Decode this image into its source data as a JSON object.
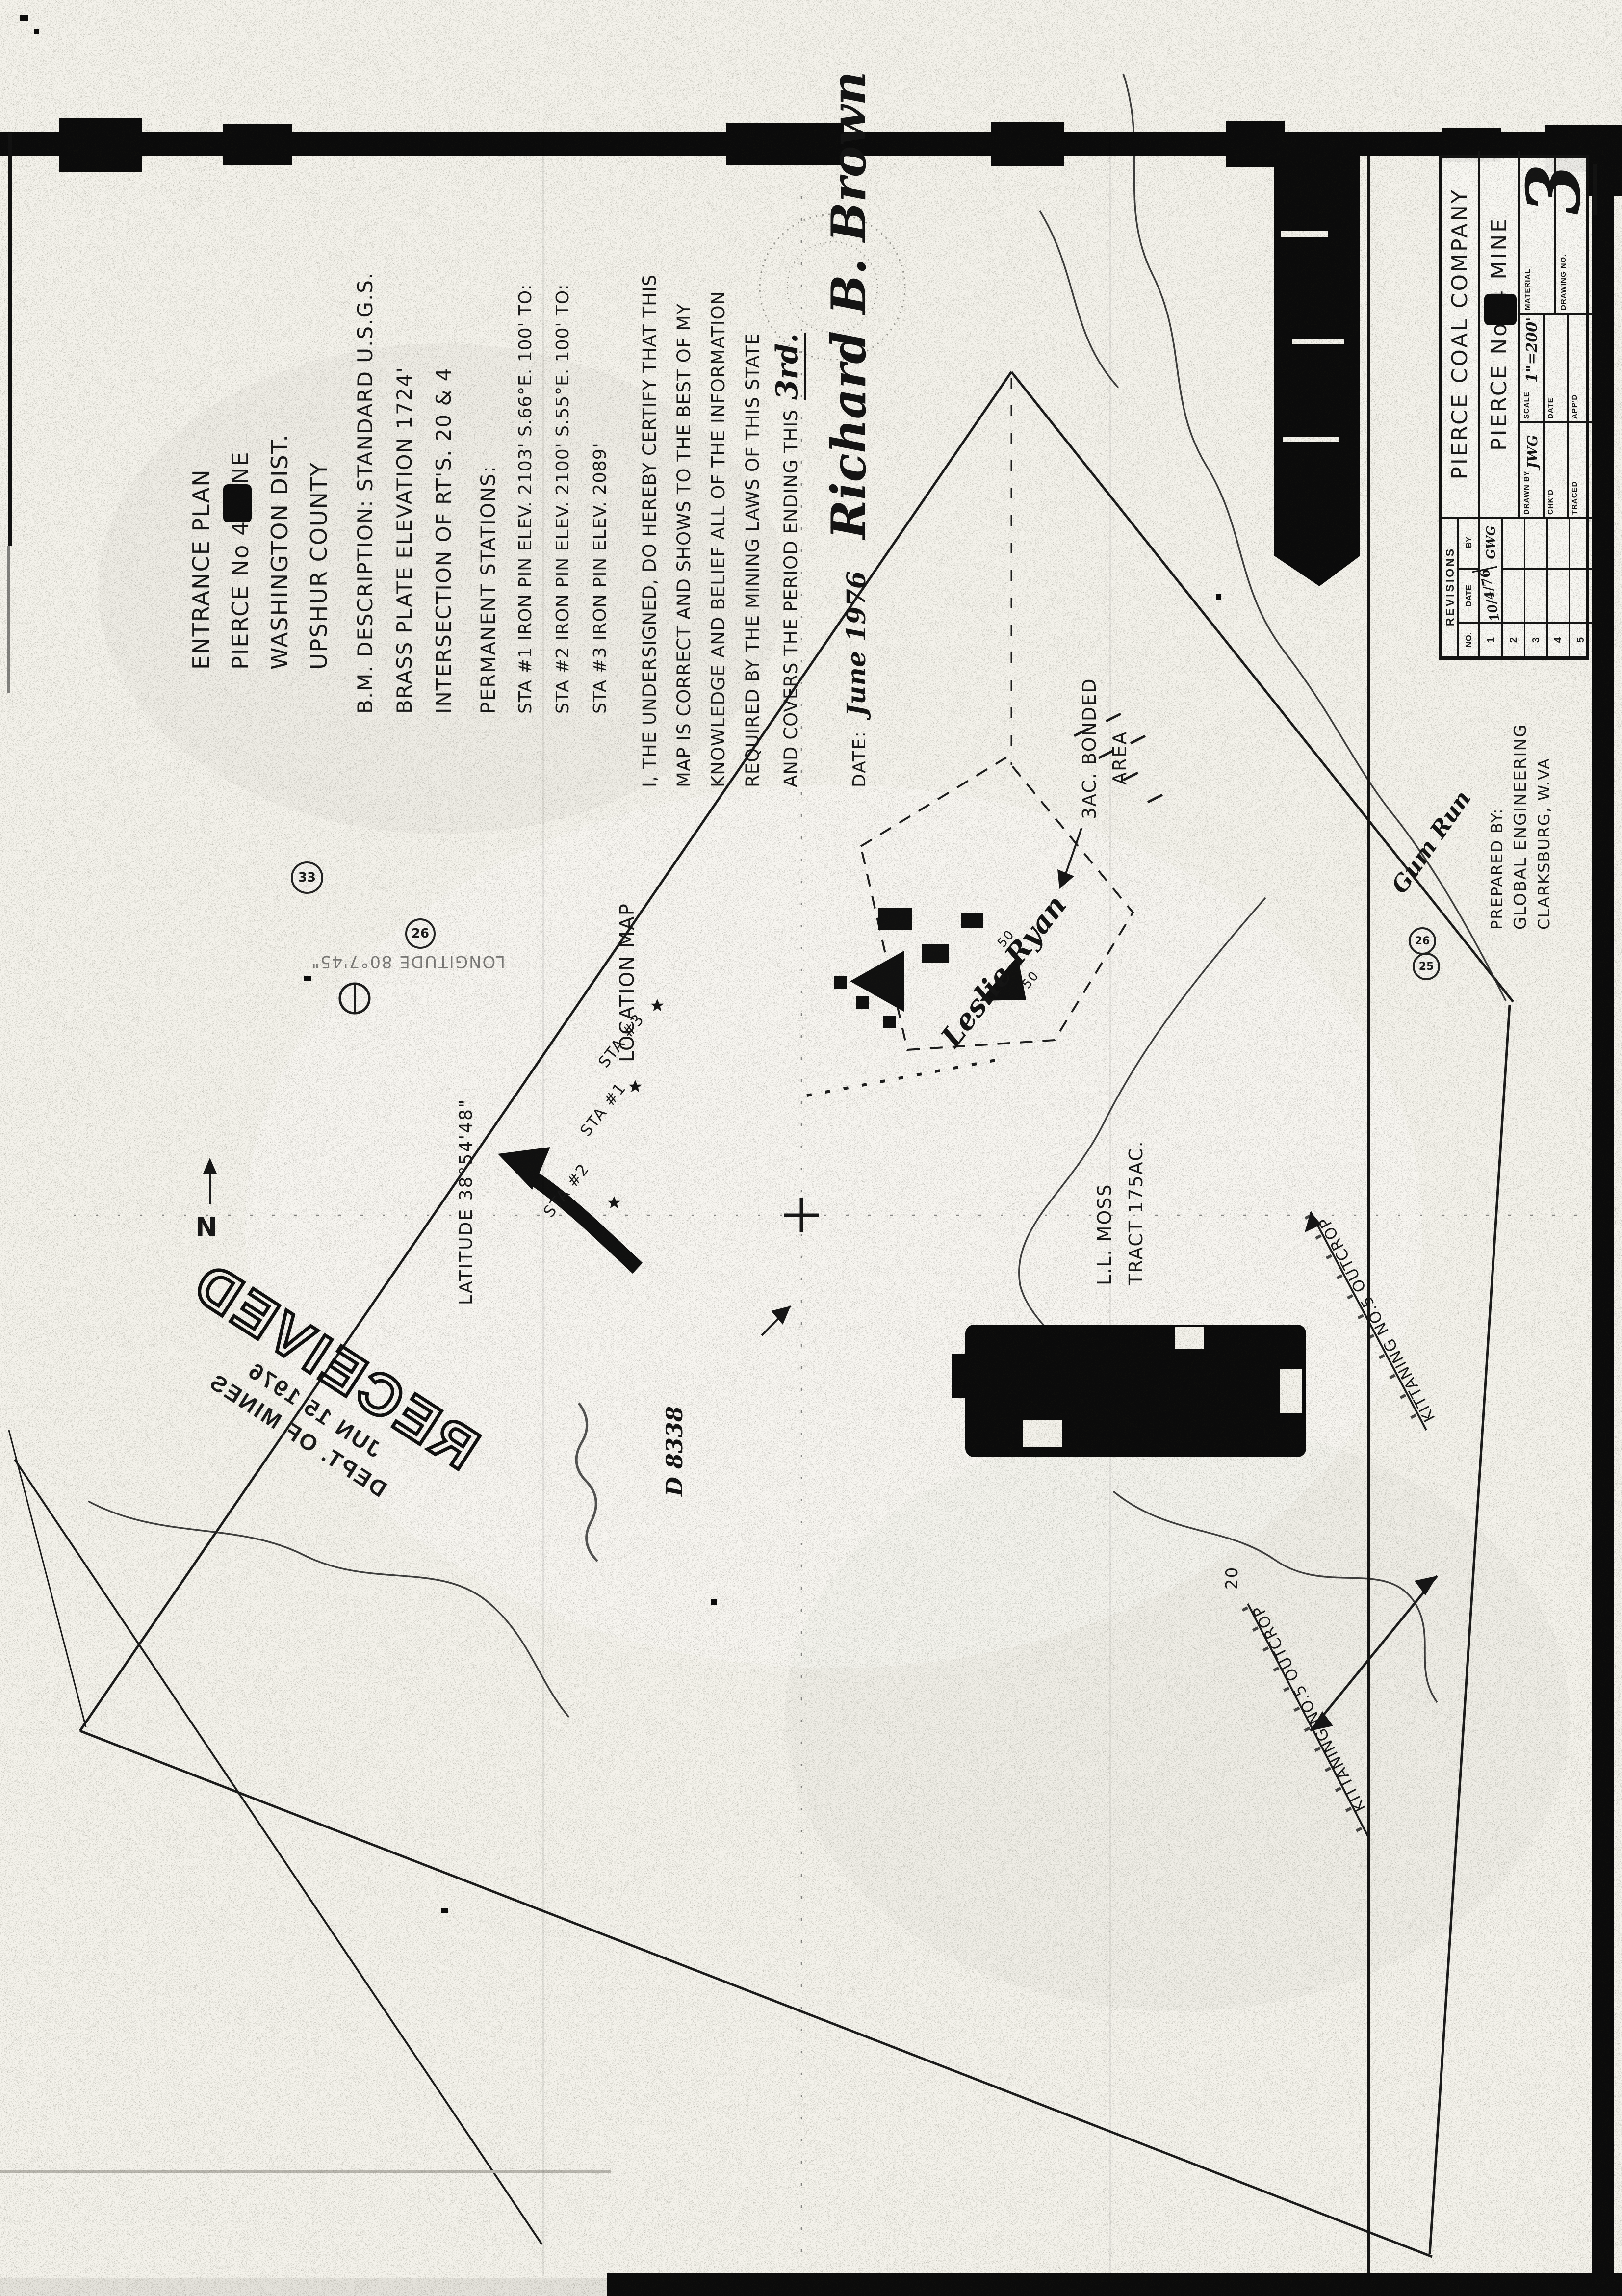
{
  "palette": {
    "paper": "#f3f1ea",
    "ink": "#1a1a1a"
  },
  "notes": {
    "title": [
      "ENTRANCE PLAN",
      "PIERCE No 4 MINE",
      "WASHINGTON DIST.",
      "UPSHUR COUNTY"
    ],
    "bm": [
      "B.M. DESCRIPTION: STANDARD U.S.G.S.",
      "BRASS PLATE ELEVATION 1724'",
      "INTERSECTION OF RT'S. 20 & 4"
    ],
    "stations": [
      "PERMANENT STATIONS:",
      "STA #1 IRON PIN ELEV. 2103' S.66°E. 100' TO:",
      "STA #2 IRON PIN ELEV. 2100' S.55°E. 100' TO:",
      "STA #3 IRON PIN ELEV. 2089'"
    ]
  },
  "certification": {
    "lines": [
      "I, THE UNDERSIGNED, DO HEREBY CERTIFY THAT THIS",
      "MAP IS CORRECT AND SHOWS TO THE BEST OF MY",
      "KNOWLEDGE AND BELIEF ALL OF THE INFORMATION",
      "REQUIRED BY THE MINING LAWS OF THIS STATE",
      "AND COVERS THE PERIOD ENDING THIS"
    ],
    "ending_day": "3rd.",
    "date_label": "DATE:",
    "date_value": "June 1976",
    "signature": "Richard B. Brown"
  },
  "stamp": {
    "word": "RECEIVED",
    "date": "JUN 15 1976",
    "dept": "DEPT. OF MINES"
  },
  "prepared_by": {
    "label": "PREPARED BY:",
    "firm": "GLOBAL ENGINEERING",
    "city": "CLARKSBURG, W.VA"
  },
  "title_block": {
    "company": "PIERCE COAL COMPANY",
    "mine": "PIERCE No. 4 MINE",
    "fields": {
      "drawn_by_label": "DRAWN BY",
      "drawn_by_value": "JWG",
      "chkd_label": "CHK'D",
      "traced_label": "TRACED",
      "scale_label": "SCALE",
      "scale_value": "1\"=200'",
      "date_label": "DATE",
      "appd_label": "APP'D",
      "material_label": "MATERIAL",
      "drawing_no_label": "DRAWING NO.",
      "drawing_no_value": "3"
    },
    "revisions": {
      "header": "REVISIONS",
      "cols": [
        "NO.",
        "DATE",
        "BY"
      ],
      "rows": [
        {
          "no": "1",
          "date": "10/4/76",
          "by": "GWG"
        },
        {
          "no": "2",
          "date": "",
          "by": ""
        },
        {
          "no": "3",
          "date": "",
          "by": ""
        },
        {
          "no": "4",
          "date": "",
          "by": ""
        },
        {
          "no": "5",
          "date": "",
          "by": ""
        }
      ]
    }
  },
  "map": {
    "location_map": "LOCATION MAP",
    "bonded1": "3AC. BONDED",
    "bonded2": "AREA",
    "owner": "Leslie Ryan",
    "moss1": "L.L. MOSS",
    "moss2": "TRACT 175AC.",
    "stream": "Gum Run",
    "outcrop1": "KITTANING NO.5 OUTCROP",
    "outcrop2": "KITTANING NO.5 OUTCROP",
    "latitude": "LATITUDE 38°54'48\"",
    "longitude": "LONGITUDE 80°7'45\"",
    "sta1": "STA #1",
    "sta2": "STA #2",
    "sta3": "STA #3",
    "north": "N",
    "circle33": "33",
    "circle26_left": "26",
    "circle26_right": "26",
    "circle25_right": "25",
    "num20": "20",
    "num50a": "50",
    "num50b": "50",
    "d_number": "D 8338"
  }
}
